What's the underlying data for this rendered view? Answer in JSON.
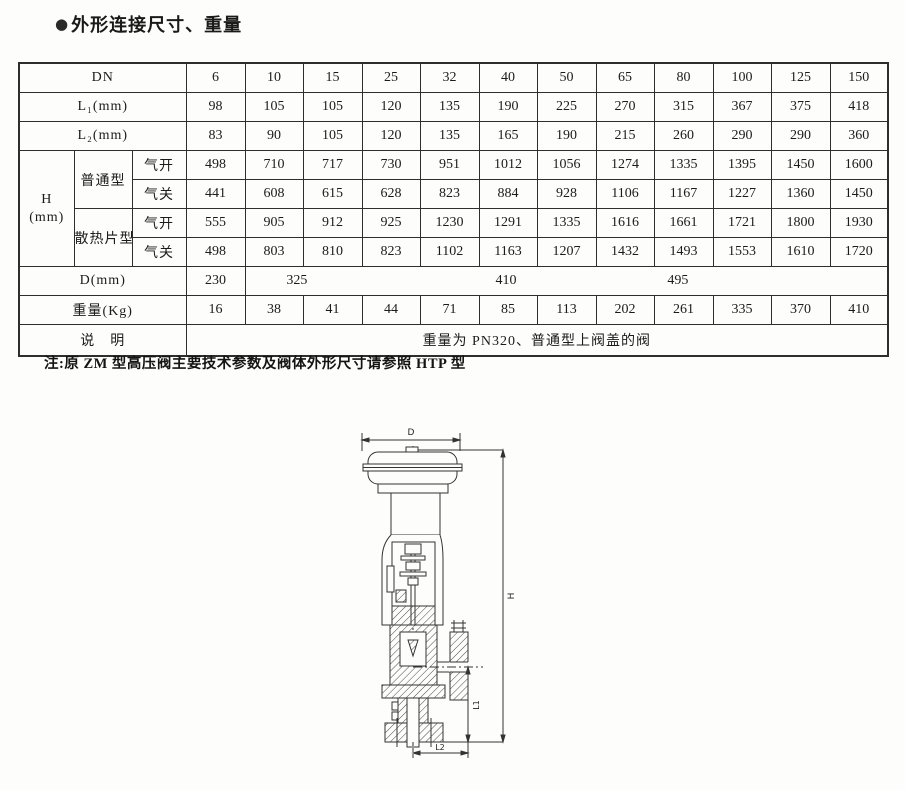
{
  "title": {
    "bullet": "●",
    "text": "外形连接尺寸、重量"
  },
  "table": {
    "rows": [
      {
        "label": "DN",
        "values": [
          "6",
          "10",
          "15",
          "25",
          "32",
          "40",
          "50",
          "65",
          "80",
          "100",
          "125",
          "150"
        ]
      },
      {
        "label": "L₁(mm)",
        "values": [
          "98",
          "105",
          "105",
          "120",
          "135",
          "190",
          "225",
          "270",
          "315",
          "367",
          "375",
          "418"
        ]
      },
      {
        "label": "L₂(mm)",
        "values": [
          "83",
          "90",
          "105",
          "120",
          "135",
          "165",
          "190",
          "215",
          "260",
          "290",
          "290",
          "360"
        ]
      }
    ],
    "h_block": {
      "label": "H",
      "label_unit": "(mm)",
      "groups": [
        {
          "name": "普通型",
          "rows": [
            {
              "label": "气开",
              "values": [
                "498",
                "710",
                "717",
                "730",
                "951",
                "1012",
                "1056",
                "1274",
                "1335",
                "1395",
                "1450",
                "1600"
              ]
            },
            {
              "label": "气关",
              "values": [
                "441",
                "608",
                "615",
                "628",
                "823",
                "884",
                "928",
                "1106",
                "1167",
                "1227",
                "1360",
                "1450"
              ]
            }
          ]
        },
        {
          "name": "散热片型",
          "rows": [
            {
              "label": "气开",
              "values": [
                "555",
                "905",
                "912",
                "925",
                "1230",
                "1291",
                "1335",
                "1616",
                "1661",
                "1721",
                "1800",
                "1930"
              ]
            },
            {
              "label": "气关",
              "values": [
                "498",
                "803",
                "810",
                "823",
                "1102",
                "1163",
                "1207",
                "1432",
                "1493",
                "1553",
                "1610",
                "1720"
              ]
            }
          ]
        }
      ]
    },
    "d_row": {
      "label": "D(mm)",
      "first": "230",
      "merged": [
        "325",
        "410",
        "495"
      ]
    },
    "weight_row": {
      "label": "重量(Kg)",
      "values": [
        "16",
        "38",
        "41",
        "44",
        "71",
        "85",
        "113",
        "202",
        "261",
        "335",
        "370",
        "410"
      ]
    },
    "remark_row": {
      "label": "说　明",
      "value": "重量为 PN320、普通型上阀盖的阀"
    }
  },
  "note": "注:原 ZM 型高压阀主要技术参数及阀体外形尺寸请参照 HTP 型",
  "drawing": {
    "dim_d": "D",
    "dim_h": "H",
    "dim_l1": "L1",
    "dim_l2": "L2"
  },
  "colors": {
    "line": "#333333",
    "text": "#1b1b1b"
  }
}
